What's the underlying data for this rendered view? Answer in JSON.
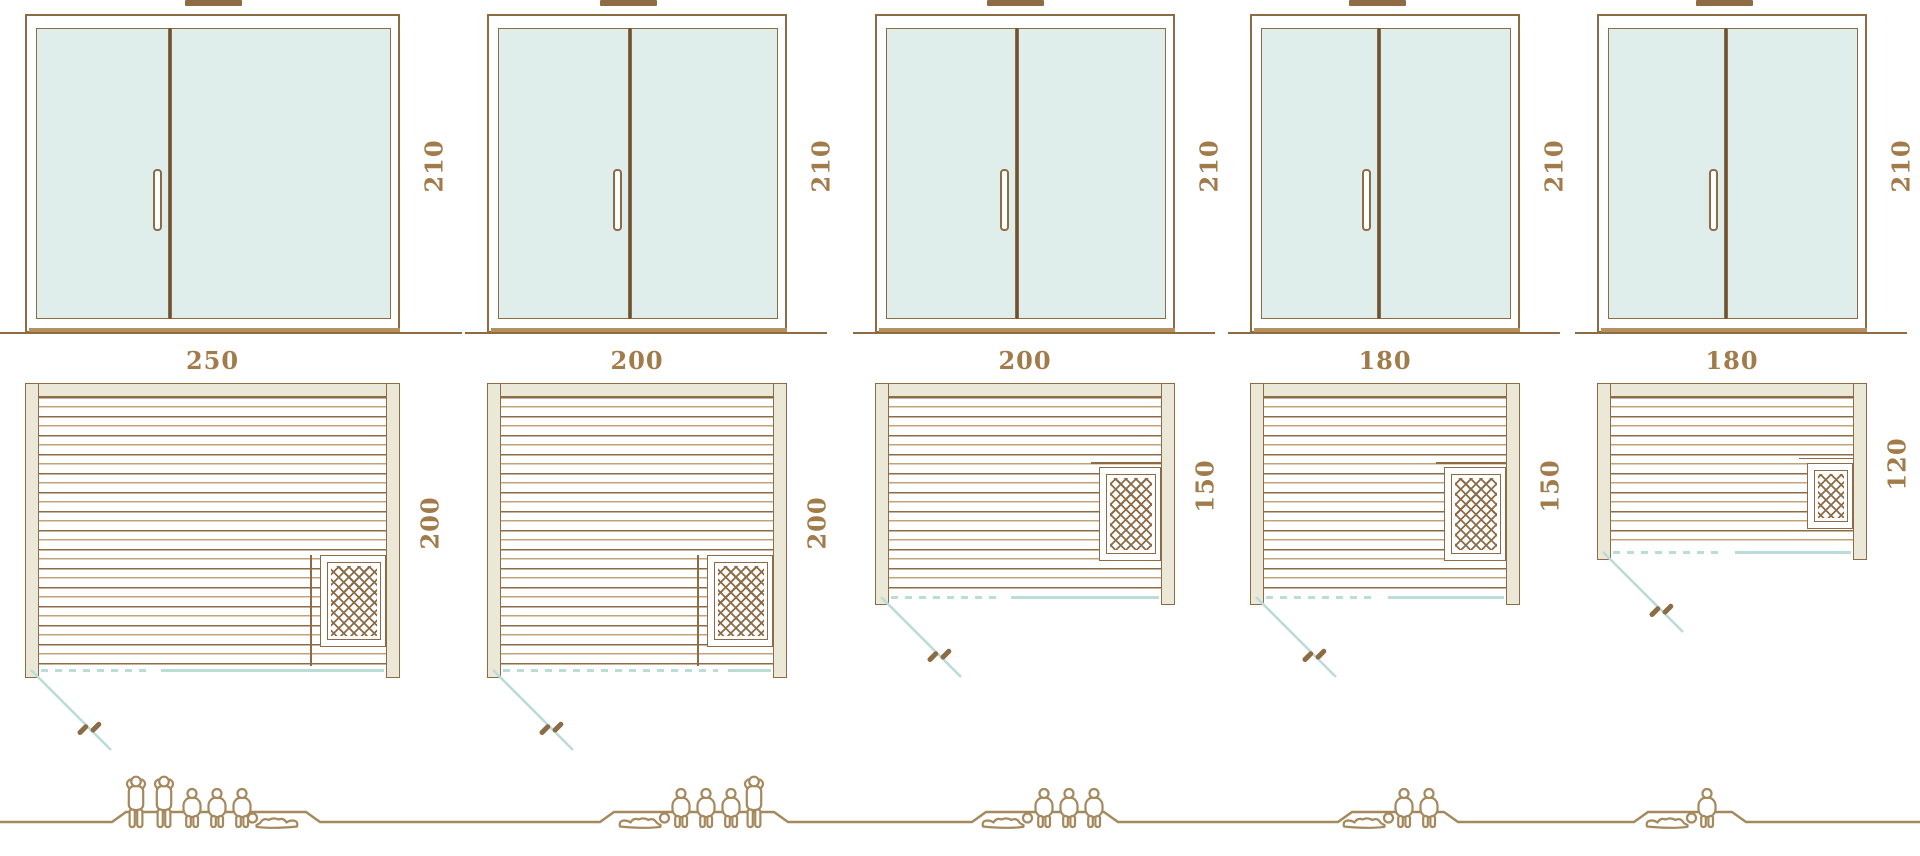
{
  "diagram": {
    "name": "sauna-size-comparison",
    "palette": {
      "outline_brown": "#8d6b45",
      "dark_brown": "#6a5336",
      "light_tan": "#c2a379",
      "wall_beige": "#ebe8d7",
      "glass_mint": "#dfeeea",
      "swing_teal": "#bcdcd7",
      "label_brown": "#a27b4b"
    },
    "models": [
      {
        "door": {
          "height_label": "210",
          "handle_icon": "door-handle"
        },
        "plan": {
          "width_label": "250",
          "depth_label": "200",
          "heater_icon": "sauna-heater",
          "heater_position": "bottom-right",
          "door_swing": "open-out-left"
        },
        "capacity": {
          "count": 6,
          "figures": [
            "standing",
            "standing",
            "sitting",
            "sitting",
            "sitting",
            "lying"
          ]
        }
      },
      {
        "door": {
          "height_label": "210",
          "handle_icon": "door-handle"
        },
        "plan": {
          "width_label": "200",
          "depth_label": "200",
          "heater_icon": "sauna-heater",
          "heater_position": "bottom-right",
          "door_swing": "open-out-left"
        },
        "capacity": {
          "count": 5,
          "figures": [
            "lying",
            "sitting",
            "sitting",
            "sitting",
            "standing"
          ]
        }
      },
      {
        "door": {
          "height_label": "210",
          "handle_icon": "door-handle"
        },
        "plan": {
          "width_label": "200",
          "depth_label": "150",
          "heater_icon": "sauna-heater",
          "heater_position": "middle-right",
          "door_swing": "open-out-left"
        },
        "capacity": {
          "count": 4,
          "figures": [
            "lying",
            "sitting",
            "sitting",
            "sitting"
          ]
        }
      },
      {
        "door": {
          "height_label": "210",
          "handle_icon": "door-handle"
        },
        "plan": {
          "width_label": "180",
          "depth_label": "150",
          "heater_icon": "sauna-heater",
          "heater_position": "middle-right",
          "door_swing": "open-out-left"
        },
        "capacity": {
          "count": 3,
          "figures": [
            "lying",
            "sitting",
            "sitting"
          ]
        }
      },
      {
        "door": {
          "height_label": "210",
          "handle_icon": "door-handle"
        },
        "plan": {
          "width_label": "180",
          "depth_label": "120",
          "heater_icon": "sauna-heater",
          "heater_position": "middle-right",
          "door_swing": "open-out-left"
        },
        "capacity": {
          "count": 2,
          "figures": [
            "lying",
            "sitting"
          ]
        }
      }
    ]
  }
}
